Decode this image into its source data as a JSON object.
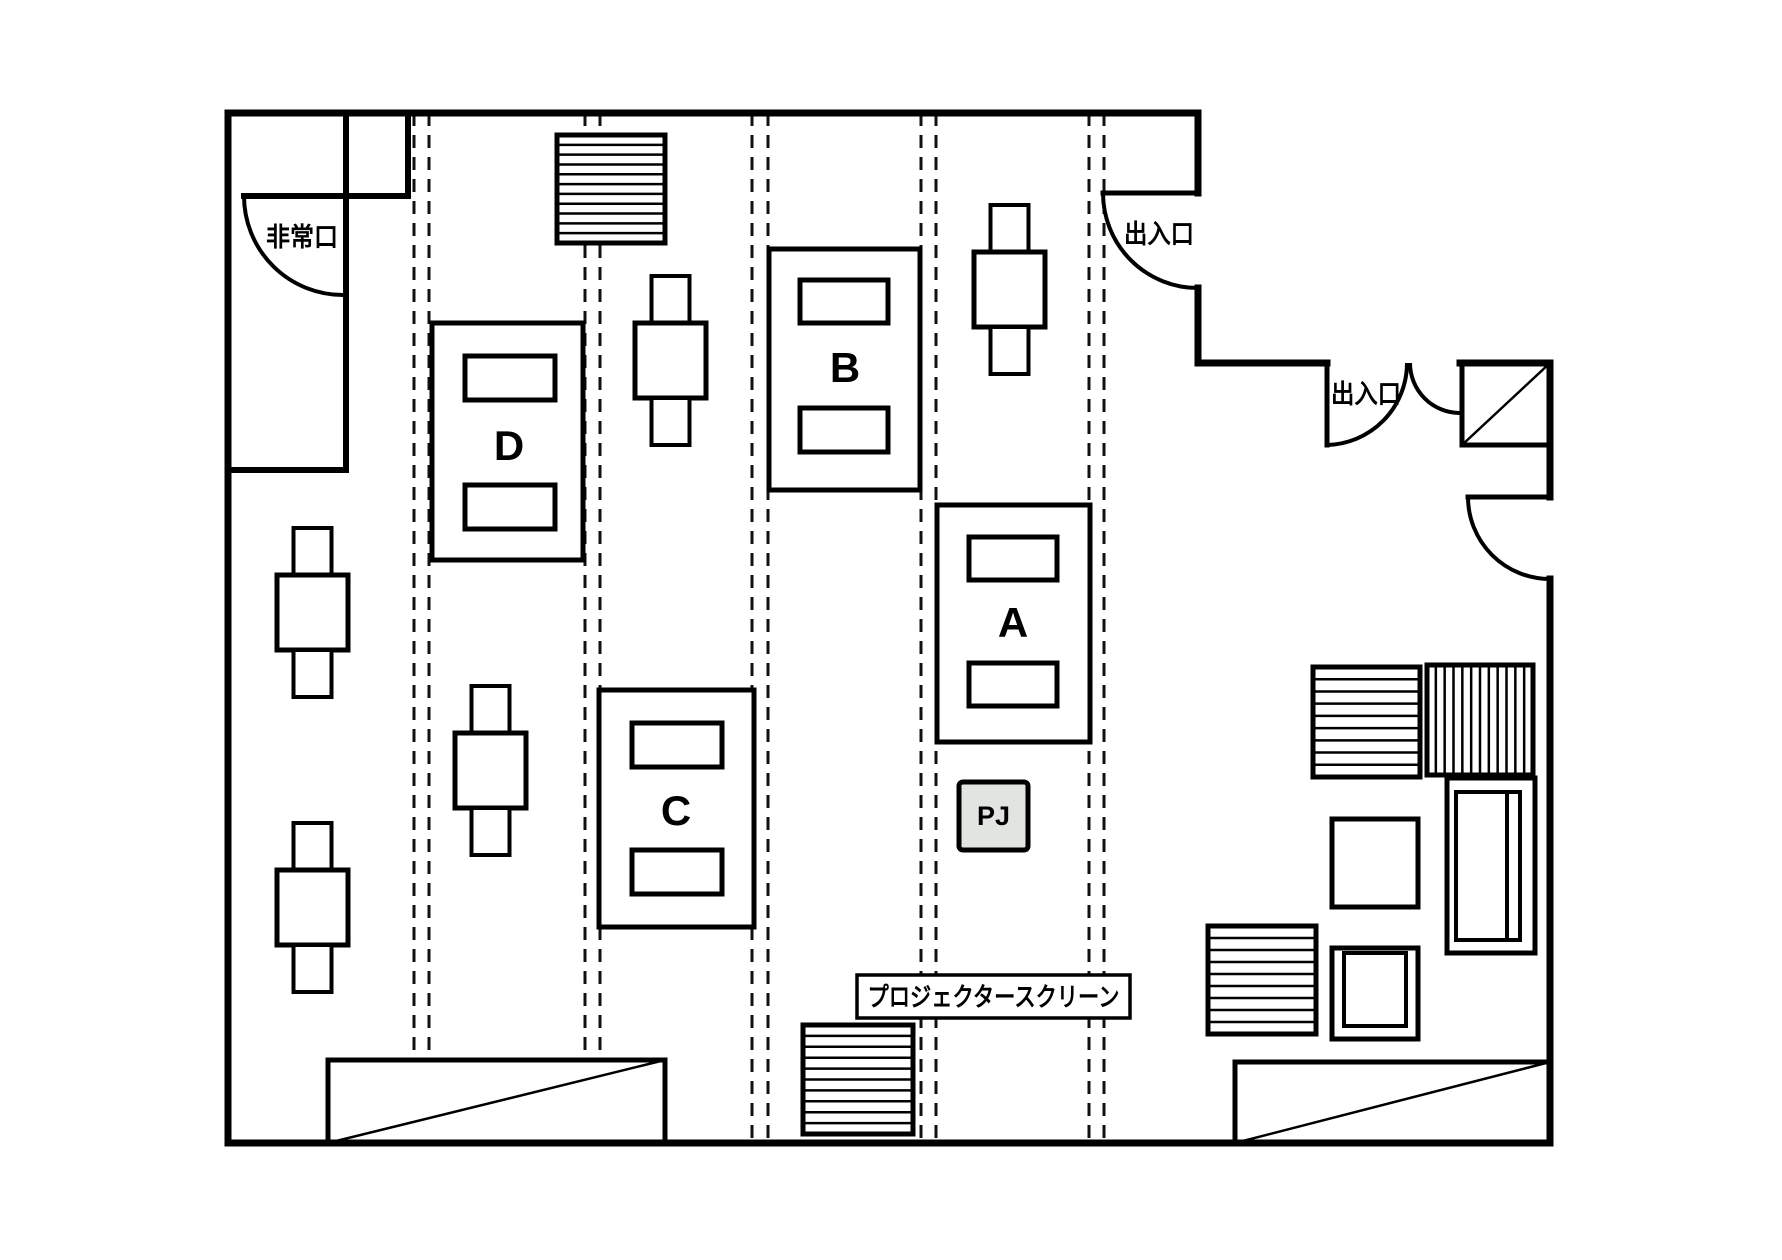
{
  "labels": {
    "emergency_exit": "非常口",
    "entrance": "出入口",
    "projector_screen": "プロジェクタースクリーン",
    "projector": "PJ",
    "table_a": "A",
    "table_b": "B",
    "table_c": "C",
    "table_d": "D"
  },
  "colors": {
    "line": "#000000",
    "background": "#ffffff",
    "pj_fill": "#e2e4e2"
  },
  "plan": {
    "canvas": {
      "w": 1782,
      "h": 1260
    },
    "partitions": {
      "x_pairs": [
        [
          414,
          429
        ],
        [
          585,
          600
        ],
        [
          752,
          768
        ],
        [
          921,
          936
        ],
        [
          1089,
          1104
        ]
      ],
      "y1": 113,
      "y2": 1140
    },
    "walls": [
      [
        228,
        113,
        1198,
        113
      ],
      [
        1198,
        113,
        1198,
        193
      ],
      [
        1198,
        288,
        1198,
        363
      ],
      [
        1198,
        363,
        1327,
        363
      ],
      [
        1460,
        363,
        1550,
        363
      ],
      [
        1550,
        363,
        1550,
        497
      ],
      [
        1550,
        579,
        1550,
        1143
      ],
      [
        228,
        1143,
        1550,
        1143
      ],
      [
        228,
        113,
        228,
        1143
      ]
    ],
    "interior_walls": [
      [
        346,
        113,
        346,
        470
      ],
      [
        408,
        113,
        408,
        196
      ],
      [
        244,
        196,
        408,
        196
      ],
      [
        228,
        470,
        346,
        470
      ]
    ],
    "doors": [
      {
        "name": "emergency-exit-door",
        "leaf": null,
        "arc": "M 244 196 A 99 99 0 0 0 343 295"
      },
      {
        "name": "entrance-1-door",
        "leaf": [
          1103,
          193,
          1198,
          193
        ],
        "arc": "M 1103 193 A 95 95 0 0 0 1198 288"
      },
      {
        "name": "entrance-2-door-left",
        "leaf": [
          1327,
          363,
          1327,
          445
        ],
        "arc": "M 1327 445 A 82 82 0 0 0 1407 363"
      },
      {
        "name": "entrance-2-door-right",
        "leaf": null,
        "arc": "M 1410 363 A 50 50 0 0 0 1460 413"
      },
      {
        "name": "right-wall-door",
        "leaf": [
          1468,
          497,
          1550,
          497
        ],
        "arc": "M 1468 497 A 82 82 0 0 0 1550 579"
      }
    ],
    "tables": [
      {
        "label_ref": "table_d",
        "x": 432,
        "y": 323,
        "w": 151,
        "h": 237,
        "slots": [
          [
            465,
            356,
            90,
            44
          ],
          [
            465,
            485,
            90,
            44
          ]
        ],
        "lx": 509,
        "ly": 460
      },
      {
        "label_ref": "table_c",
        "x": 599,
        "y": 690,
        "w": 155,
        "h": 237,
        "slots": [
          [
            632,
            723,
            90,
            44
          ],
          [
            632,
            850,
            90,
            44
          ]
        ],
        "lx": 676,
        "ly": 825
      },
      {
        "label_ref": "table_b",
        "x": 769,
        "y": 249,
        "w": 151,
        "h": 241,
        "slots": [
          [
            800,
            280,
            88,
            43
          ],
          [
            800,
            408,
            88,
            44
          ]
        ],
        "lx": 845,
        "ly": 382
      },
      {
        "label_ref": "table_a",
        "x": 937,
        "y": 505,
        "w": 153,
        "h": 237,
        "slots": [
          [
            969,
            537,
            88,
            43
          ],
          [
            969,
            663,
            88,
            43
          ]
        ],
        "lx": 1013,
        "ly": 637
      }
    ],
    "chair_dims": {
      "seat_w": 71,
      "seat_h": 75,
      "tab_w": 38,
      "tab_h": 47
    },
    "chairs": [
      [
        1009.5,
        289.5
      ],
      [
        670.5,
        360.5
      ],
      [
        490.5,
        770.5
      ],
      [
        312.5,
        612.5
      ],
      [
        312.5,
        907.5
      ]
    ],
    "hatched_boxes": [
      {
        "name": "shelf-top",
        "x": 557,
        "y": 135,
        "w": 108,
        "h": 108,
        "dir": "h",
        "n": 10
      },
      {
        "name": "shelf-right-1",
        "x": 1313,
        "y": 667,
        "w": 107,
        "h": 110,
        "dir": "h",
        "n": 8
      },
      {
        "name": "shelf-right-2",
        "x": 1427,
        "y": 665,
        "w": 106,
        "h": 110,
        "dir": "v",
        "n": 11
      },
      {
        "name": "shelf-right-3",
        "x": 1208,
        "y": 926,
        "w": 108,
        "h": 108,
        "dir": "h",
        "n": 8
      },
      {
        "name": "screen-unit",
        "x": 803,
        "y": 1025,
        "w": 110,
        "h": 109,
        "dir": "h",
        "n": 9
      }
    ],
    "diagonal_boxes": [
      {
        "name": "storage-bottom-left",
        "x": 328,
        "y": 1060,
        "w": 337,
        "h": 83
      },
      {
        "name": "storage-bottom-right",
        "x": 1235,
        "y": 1062,
        "w": 315,
        "h": 81
      },
      {
        "name": "storage-top-right",
        "x": 1462,
        "y": 363,
        "w": 88,
        "h": 82
      }
    ],
    "sofa": {
      "outer": [
        1447,
        778,
        88,
        175
      ],
      "inner": [
        1456,
        792,
        64,
        148
      ],
      "line": [
        1507,
        792,
        1507,
        940
      ]
    },
    "armchair": {
      "outer": [
        1332,
        948,
        86,
        91
      ],
      "inner": [
        1344,
        953,
        62,
        73
      ]
    },
    "side_table": [
      1332,
      819,
      86,
      88
    ],
    "projector_box": {
      "x": 959,
      "y": 782,
      "w": 69,
      "h": 68,
      "tx": 993.5,
      "ty": 825
    },
    "text_labels": [
      {
        "name": "emergency-exit-label",
        "ref": "emergency_exit",
        "x": 302,
        "y": 246,
        "cls": "jp",
        "fit": 72
      },
      {
        "name": "entrance-1-label",
        "ref": "entrance",
        "x": 1159,
        "y": 243,
        "cls": "jp",
        "fit": 70
      },
      {
        "name": "entrance-2-label",
        "ref": "entrance",
        "x": 1366,
        "y": 403,
        "cls": "jp",
        "fit": 70
      },
      {
        "name": "projector-screen-label",
        "ref": "projector_screen",
        "x": 993.5,
        "y": 1006,
        "cls": "jps",
        "fit": 252,
        "box": [
          857,
          975,
          273,
          43
        ]
      }
    ]
  }
}
